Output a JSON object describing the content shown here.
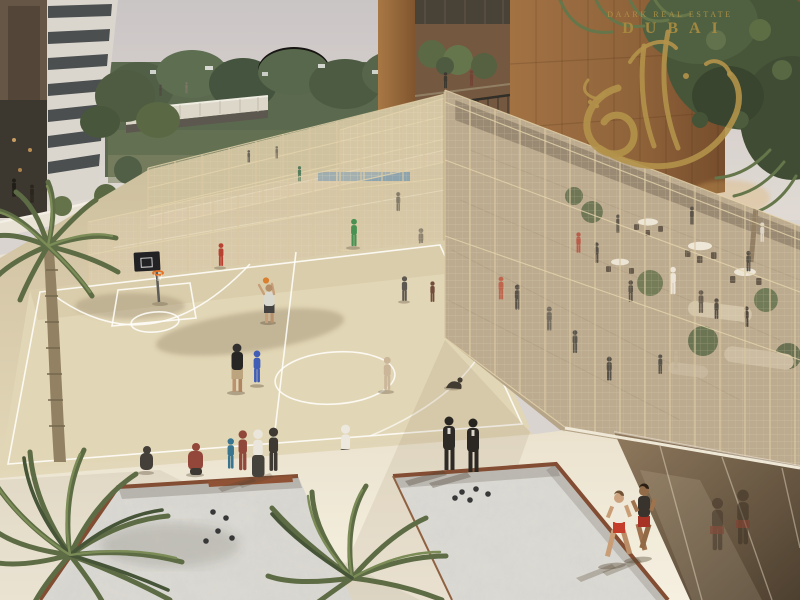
{
  "watermark": {
    "brand": "DAARK REAL ESTATE",
    "city": "DUBAI",
    "gold": "#b2924a"
  },
  "palette": {
    "sky": "#cdc7ca",
    "distant_trees": "#4b5c3b",
    "bronze_building": "#8e5e38",
    "white_tower": "#d8d5d0",
    "court_surface": "#e0d5b6",
    "cage_mesh": "#d9c7a1",
    "cafe_floor": "#b3a287",
    "walkway": "#efe8d8",
    "sand_pit": "#dcdad5",
    "pit_rim_rust": "#7c452c",
    "glass_wall": "#6e5942",
    "palm_green": "#55663f",
    "basketball_rim": "#e06a1e",
    "bench_blue": "#4a7fae"
  },
  "scene": {
    "areas": [
      "padel-cages",
      "basketball-court",
      "petanque-sand-pits",
      "cafe-terrace",
      "jogging-path",
      "palm-landscaping",
      "residential-towers"
    ]
  }
}
